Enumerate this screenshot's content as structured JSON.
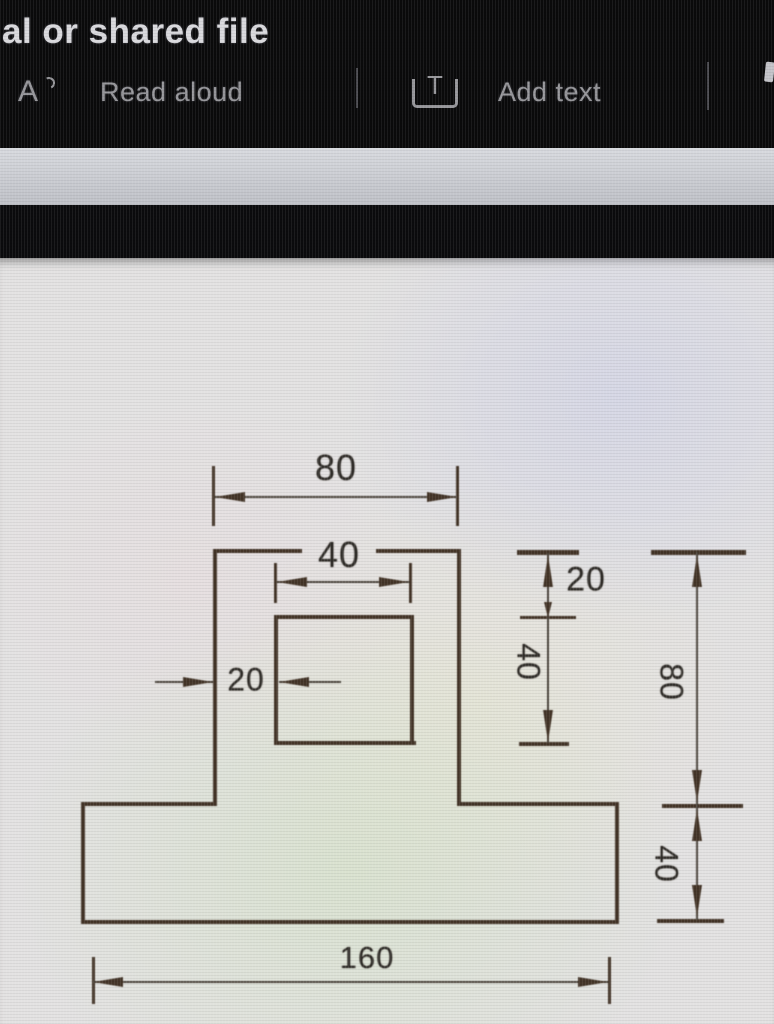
{
  "window": {
    "title_fragment": "al or shared file"
  },
  "toolbar": {
    "read_aloud": {
      "icon": "read-aloud-icon",
      "glyph": "A",
      "label": "Read aloud"
    },
    "add_text": {
      "icon": "add-text-icon",
      "glyph": "T",
      "label": "Add text"
    }
  },
  "drawing": {
    "type": "dimensioned engineering drawing of an inverted-T shaped plate with a square hole",
    "labels": {
      "top_width": "80",
      "hole_width": "40",
      "hole_offset_left": "20",
      "hole_offset_top": "20",
      "hole_height": "40",
      "column_height": "80",
      "base_height": "40",
      "base_width": "160"
    }
  },
  "colors": {
    "line": "#443528",
    "dim": "#4d463e",
    "label": "#2f2c28",
    "header_bg": "#0a0a0b",
    "bar_bg": "#cbcdd3",
    "doc_bg": "#e3e2e2",
    "toolbar_text": "#96969a",
    "title_text": "#d9d9dd"
  }
}
